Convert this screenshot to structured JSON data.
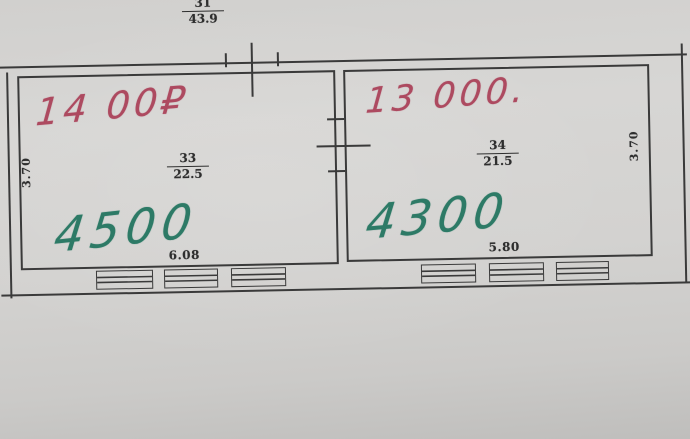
{
  "colors": {
    "paper": "#d3d2d0",
    "line_ink": "#3a3a3a",
    "red_ink": "#ad4a60",
    "green_ink": "#2d7a66"
  },
  "plan": {
    "building_dimension": {
      "numerator": "31",
      "denominator": "43.9"
    },
    "rooms": [
      {
        "handwritten_price_red": "14 00₽",
        "room_number": "33",
        "area_sqm": "22.5",
        "handwritten_price_green": "4500",
        "width_m": "6.08",
        "depth_m": "3.70",
        "window_count": 3
      },
      {
        "handwritten_price_red": "13 000.",
        "room_number": "34",
        "area_sqm": "21.5",
        "handwritten_price_green": "4300",
        "width_m": "5.80",
        "depth_m": "3.70",
        "window_count": 3
      }
    ]
  }
}
